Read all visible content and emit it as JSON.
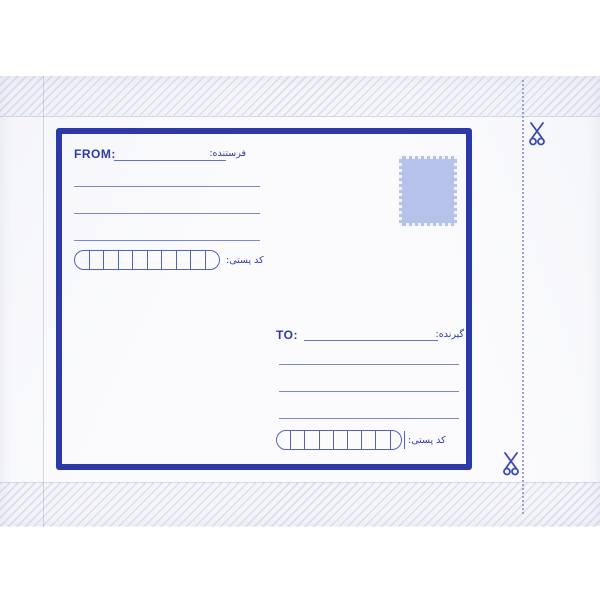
{
  "envelope": {
    "from_section": {
      "label": "FROM:",
      "sender_label_fa": "فرستنده:",
      "postal_code_label_fa": "کد پستی:",
      "address_line_count": 3,
      "postal_cell_count": 10
    },
    "to_section": {
      "label": "TO:",
      "receiver_label_fa": "گیرنده:",
      "postal_code_label_fa": "کد پستی:",
      "address_line_count": 3,
      "postal_cell_count": 10
    },
    "cut_guide": {
      "scissors_icon_count": 2
    },
    "colors": {
      "print_blue": "#2c39a8",
      "writing_line_blue": "#7b88cc",
      "stamp_fill": "#b6c2e9",
      "cut_dots": "#98a4ce",
      "envelope_white": "#fbfbfd"
    }
  }
}
